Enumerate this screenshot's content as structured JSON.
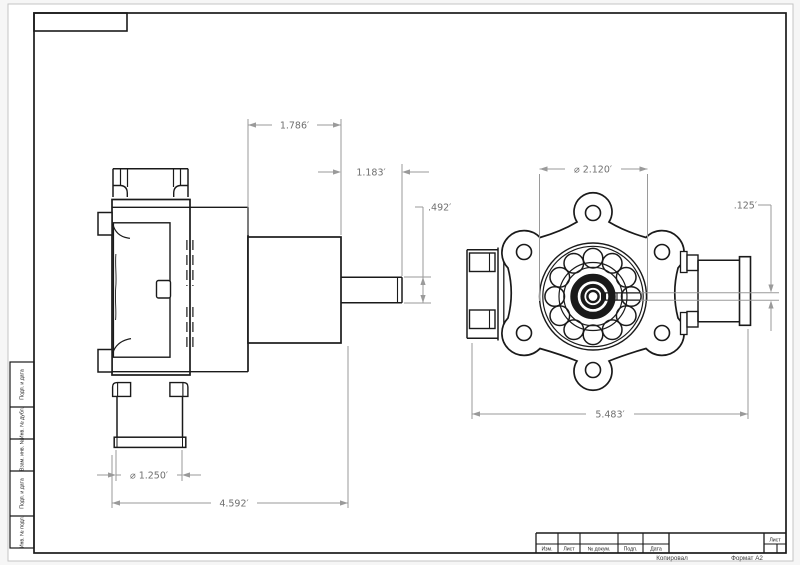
{
  "sheet": {
    "copy_label": "Копировал",
    "format_label": "Формат А2",
    "sheet_cell_label": "Лист",
    "revision_columns": [
      "Изм.",
      "Лист",
      "№ докум.",
      "Подп.",
      "Дата"
    ],
    "margin_cells": [
      "Подп. и дата",
      "Инв. № дубл.",
      "Взам. инв. №",
      "Подп. и дата",
      "Инв. № подл."
    ]
  },
  "side_view": {
    "dim_motor_length": "1.786′",
    "dim_shaft_length": "1.183′",
    "dim_shaft_diameter": ".492′",
    "dim_port_diameter": "⌀ 1.250′",
    "dim_overall_length": "4.592′"
  },
  "front_view": {
    "dim_housing_diameter": "⌀ 2.120′",
    "dim_slot_width": ".125′",
    "dim_overall_width": "5.483′"
  },
  "colors": {
    "line": "#1a1a1a",
    "dimension_line": "#9a9a9a",
    "dimension_text": "#6f6f6f",
    "paper": "#ffffff"
  }
}
